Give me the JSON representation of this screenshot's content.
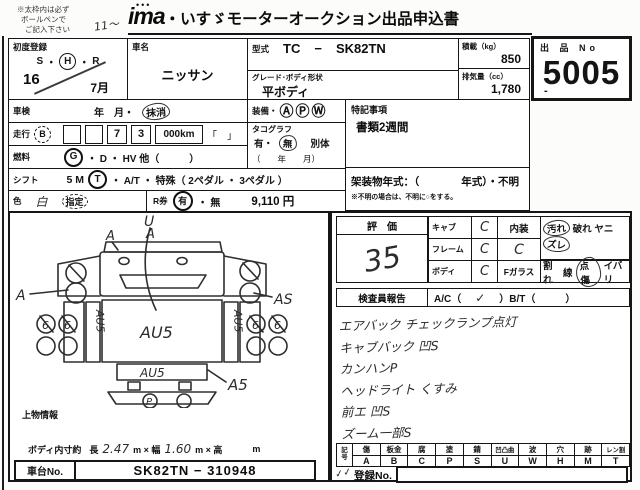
{
  "header": {
    "note1": "※太枠内は必ず",
    "note2": "ボールペンで",
    "note3": "ご記入下さい",
    "hand_mark": "11〜",
    "logo_dots": "•••",
    "logo": "ima",
    "title": "・いすゞモーターオークション出品申込書"
  },
  "lot": {
    "label": "出 品 No",
    "number": "5005",
    "dash": "-"
  },
  "row1": {
    "first_reg": {
      "label": "初度登録",
      "era_s": "S",
      "dot1": "・",
      "era_h": "H",
      "dot2": "・",
      "era_r": "R",
      "year": "16",
      "month": "7月"
    },
    "car_name": {
      "label": "車名",
      "value": "ニッサン"
    },
    "model": {
      "label": "型式",
      "v1": "TC",
      "dash": "−",
      "v2": "SK82TN"
    },
    "grade": {
      "label": "グレード･ボディ形状",
      "value": "平ボディ"
    },
    "payload": {
      "label": "積載（kg）",
      "value": "850"
    },
    "disp": {
      "label": "排気量（cc）",
      "value": "1,780"
    }
  },
  "rows": {
    "shaken": {
      "label": "車検",
      "pre": "年　月・",
      "circled": "抹消"
    },
    "equip": {
      "label": "装備・",
      "icon1": "Ⓐ",
      "icon2": "Ⓟ",
      "icon3": "Ⓦ"
    },
    "tokki": {
      "label": "特記事項",
      "value": "書類2週間"
    },
    "mileage": {
      "label": "走行",
      "badge": "B",
      "b1": "",
      "b2": "",
      "d1": "7",
      "d2": "3",
      "unit": "000km",
      "brackets": "「　」"
    },
    "tacho": {
      "label": "タコグラフ",
      "yes": "有・",
      "no": "無",
      "extra": "別体",
      "ym": "（　　年　　月）"
    },
    "fuel": {
      "label": "燃料",
      "g": "G",
      "rest": "・ D ・ HV 他（　　　）"
    },
    "shift": {
      "label": "シフト",
      "pre": "5 M",
      "circled": "T",
      "rest": "・ A/T ・ 特殊（ 2ペダル ・ 3ペダル ）"
    },
    "kasou": {
      "label": "架装物年式：（　　　　年式）・不明",
      "note": "※不明の場合は、不明に○をする。"
    },
    "color": {
      "label": "色",
      "hand": "白",
      "shitei": "指定"
    },
    "rken": {
      "label": "R券",
      "circled": "有",
      "rest": "・ 無",
      "price": "9,110 円"
    }
  },
  "eval": {
    "header": "評　価",
    "score": "35",
    "cab": {
      "label": "キャブ",
      "value": "C"
    },
    "frame": {
      "label": "フレーム",
      "value": "C"
    },
    "body": {
      "label": "ボディ",
      "value": "C"
    },
    "interior": {
      "label": "内装",
      "value": "C",
      "d1": "汚れ",
      "d2": "破れ",
      "d3": "ヤニ",
      "d4": "ズレ"
    },
    "fglass": {
      "label": "Fガラス",
      "d1": "割れ",
      "d2": "線",
      "d3": "点傷",
      "d4": "イバリ"
    }
  },
  "inspector": {
    "label": "検査員報告",
    "ac": "A/C（",
    "check": "✓",
    "mid": "）B/T（",
    "end": "　　　）",
    "lines": [
      "エアバック チェックランプ点灯",
      "キャブバック 凹S",
      "カンハンP",
      "ヘッドライト くすみ",
      "前エ 凹S",
      "ズーム一部S"
    ]
  },
  "legend": {
    "corner_top": "記",
    "corner_bottom": "号",
    "cols": [
      {
        "k": "傷",
        "c": "A"
      },
      {
        "k": "板金",
        "c": "B"
      },
      {
        "k": "腐",
        "c": "C"
      },
      {
        "k": "塗",
        "c": "P"
      },
      {
        "k": "錆",
        "c": "S"
      },
      {
        "k": "凹凸曲",
        "c": "U"
      },
      {
        "k": "波",
        "c": "W"
      },
      {
        "k": "穴",
        "c": "H"
      },
      {
        "k": "跡",
        "c": "M"
      },
      {
        "k": "レン割",
        "c": "T"
      }
    ]
  },
  "bottom": {
    "joubutsu": "上物情報",
    "dims": {
      "label": "ボディ内寸約",
      "l1": "長",
      "v1": "2.47",
      "l2": "m × 幅",
      "v2": "1.60",
      "l3": "m × 高",
      "unit": "m"
    },
    "chassis": {
      "label": "車台No.",
      "value": "SK82TN − 310948"
    },
    "reg": {
      "check": "✓✓",
      "label": "登録No."
    }
  },
  "diagram": {
    "u": "U",
    "a_top1": "A",
    "a_top2": "A",
    "a_left": "A",
    "as_right": "AS",
    "six": "6",
    "au5": "AU5",
    "a5": "A5",
    "p": "P"
  }
}
